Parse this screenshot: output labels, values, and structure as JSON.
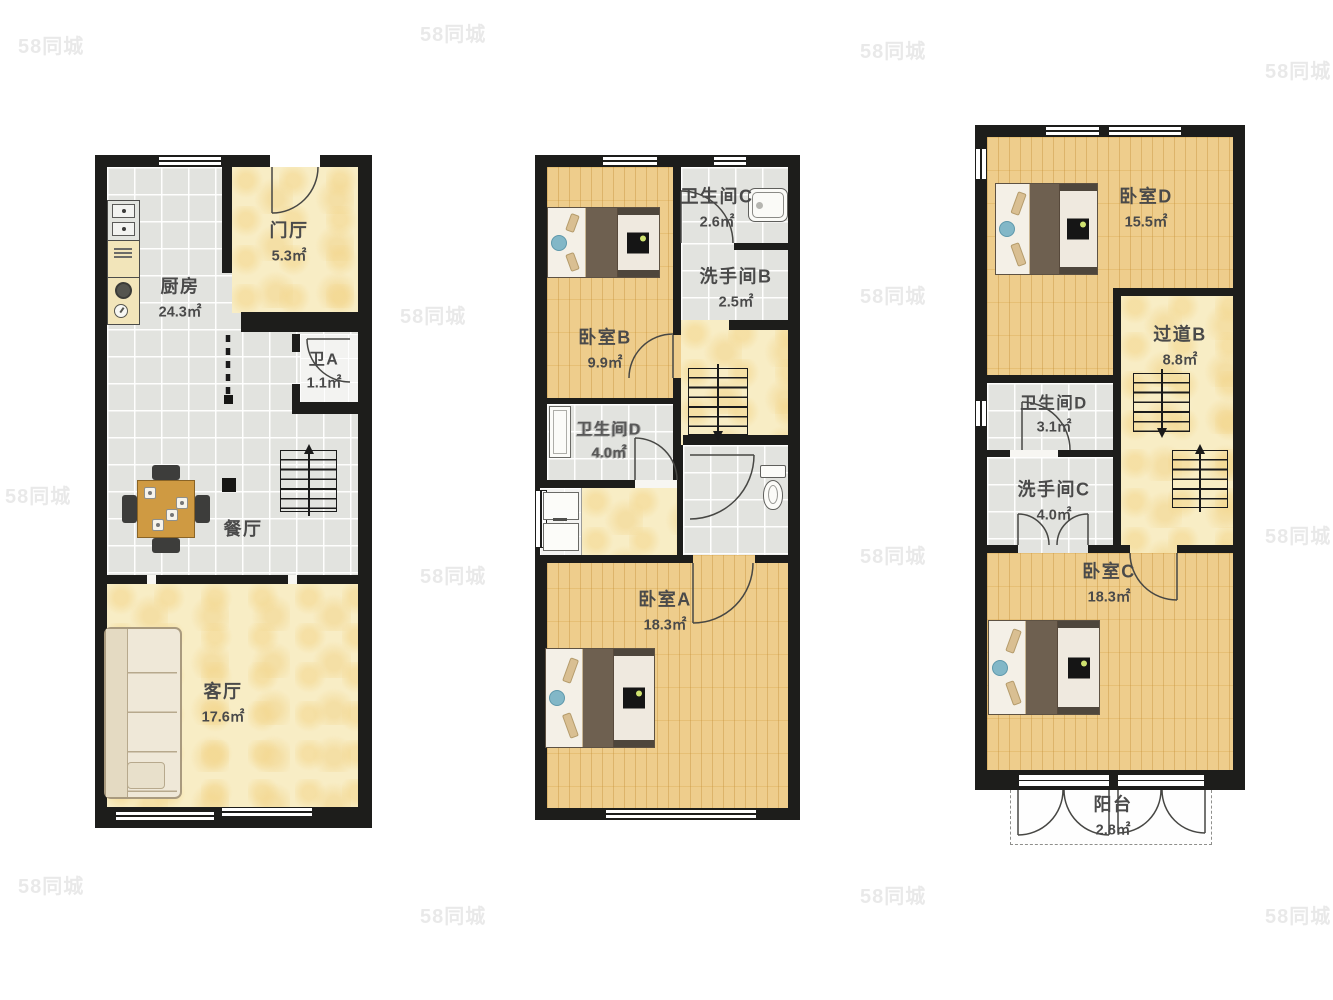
{
  "watermark": {
    "text": "58同城"
  },
  "colors": {
    "wall": "#1d1d1b",
    "tile_floor": "#e2e3df",
    "wood_floor": "#eecd8c",
    "marble_floor": "#f8edc5",
    "label_text": "#4a4a4a",
    "duvet_brown": "#6e6050",
    "accent_blue": "#82b7c7",
    "table_wood": "#cf9a42"
  },
  "floors": [
    {
      "id": "level-1",
      "rooms": [
        {
          "name": "厨房",
          "area": "24.3㎡"
        },
        {
          "name": "门厅",
          "area": "5.3㎡"
        },
        {
          "name": "卫A",
          "area": "1.1㎡"
        },
        {
          "name": "餐厅"
        },
        {
          "name": "客厅",
          "area": "17.6㎡"
        }
      ]
    },
    {
      "id": "level-2",
      "rooms": [
        {
          "name": "卧室B",
          "area": "9.9㎡"
        },
        {
          "name": "卫生间C",
          "area": "2.6㎡"
        },
        {
          "name": "洗手间B",
          "area": "2.5㎡"
        },
        {
          "name": "卫生间D",
          "area": "4.0㎡"
        },
        {
          "name": "卧室A",
          "area": "18.3㎡"
        }
      ]
    },
    {
      "id": "level-3",
      "rooms": [
        {
          "name": "卧室D",
          "area": "15.5㎡"
        },
        {
          "name": "过道B",
          "area": "8.8㎡"
        },
        {
          "name": "卫生间D",
          "area": "3.1㎡"
        },
        {
          "name": "洗手间C",
          "area": "4.0㎡"
        },
        {
          "name": "卧室C",
          "area": "18.3㎡"
        },
        {
          "name": "阳台",
          "area": "2.8㎡"
        }
      ]
    }
  ]
}
